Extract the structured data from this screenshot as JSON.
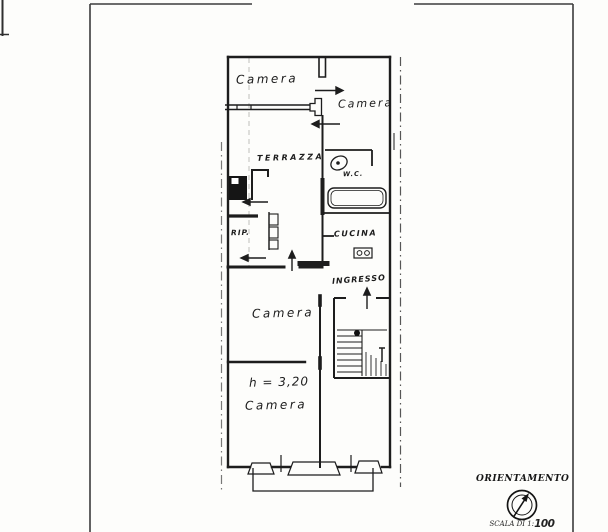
{
  "floorplan": {
    "rooms": [
      {
        "id": "camera-top-left",
        "label": "Camera"
      },
      {
        "id": "camera-top-right",
        "label": "Camera"
      },
      {
        "id": "terrazza",
        "label": "TERRAZZA"
      },
      {
        "id": "wc",
        "label": "W.C."
      },
      {
        "id": "ripostiglio",
        "label": "RIP."
      },
      {
        "id": "cucina",
        "label": "CUCINA"
      },
      {
        "id": "ingresso",
        "label": "INGRESSO"
      },
      {
        "id": "camera-middle",
        "label": "Camera"
      },
      {
        "id": "camera-bottom",
        "label": "Camera"
      }
    ],
    "annotations": {
      "ceiling_height": "h = 3,20"
    }
  },
  "legend": {
    "orientation_label": "ORIENTAMENTO",
    "scale_prefix": "SCALA DI 1:",
    "scale_value": "100"
  },
  "icons": {
    "compass-icon": "double-circle-with-north-needle",
    "toilet-icon": "oval-bowl-with-dot",
    "bathtub-icon": "rounded-rectangle-tub",
    "stove-icon": "rectangle-with-two-burners",
    "elevator-shaft-icon": "solid-black-square",
    "staircase-icon": "hatched-step-run",
    "door-swing-arrow-icon": "direction-arrow"
  },
  "colors": {
    "paper": "#fdfdfb",
    "ink": "#1d1d1d",
    "boundary_line": "#555555"
  }
}
